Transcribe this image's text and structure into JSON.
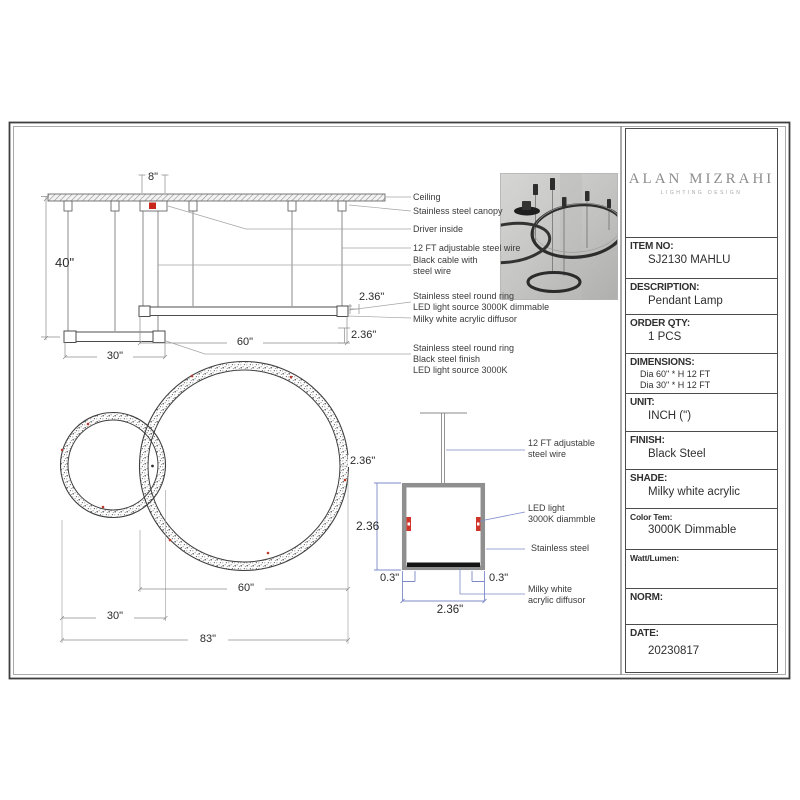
{
  "brand": {
    "name": "ALAN MIZRAHI",
    "tagline": "LIGHTING DESIGN"
  },
  "panel": {
    "item_label": "ITEM NO:",
    "item_value": "SJ2130 MAHLU",
    "desc_label": "DESCRIPTION:",
    "desc_value": "Pendant Lamp",
    "qty_label": "ORDER QTY:",
    "qty_value": "1 PCS",
    "dim_label": "DIMENSIONS:",
    "dim_value1": "Dia 60\" * H 12 FT",
    "dim_value2": "Dia 30\" * H 12 FT",
    "unit_label": "UNIT:",
    "unit_value": "INCH (\")",
    "finish_label": "FINISH:",
    "finish_value": "Black Steel",
    "shade_label": "SHADE:",
    "shade_value": "Milky white acrylic",
    "color_label": "Color Tem:",
    "color_value": "3000K Dimmable",
    "watt_label": "Watt/Lumen:",
    "watt_value": "",
    "norm_label": "NORM:",
    "norm_value": "",
    "date_label": "DATE:",
    "date_value": "20230817"
  },
  "elevation": {
    "dim_8": "8\"",
    "dim_40": "40\"",
    "dim_60": "60\"",
    "dim_30": "30\"",
    "dim_236_top": "2.36\"",
    "dim_236_bottom": "2.36\"",
    "label_ceiling": "Ceiling",
    "label_canopy": "Stainless steel canopy",
    "label_driver": "Driver inside",
    "label_wire": "12 FT adjustable steel wire",
    "label_black_cable_1": "Black cable with",
    "label_black_cable_2": "steel wire",
    "label_ring_top_1": "Stainless steel round ring",
    "label_ring_top_2": "LED light source 3000K dimmable",
    "label_diffusor": "Milky white acrylic diffusor",
    "label_ring_bot_1": "Stainless steel round ring",
    "label_ring_bot_2": "Black steel finish",
    "label_ring_bot_3": "LED light source 3000K"
  },
  "plan": {
    "dim_236": "2.36\"",
    "dim_60": "60\"",
    "dim_30": "30\"",
    "dim_83": "83\""
  },
  "section": {
    "label_wire_1": "12 FT adjustable",
    "label_wire_2": "steel wire",
    "label_led_1": "LED light",
    "label_led_2": "3000K diammble",
    "label_steel": "Stainless steel",
    "label_milky_1": "Milky white",
    "label_milky_2": "acrylic diffusor",
    "dim_left": "2.36",
    "dim_03_left": "0.3\"",
    "dim_03_right": "0.3\"",
    "dim_bottom": "2.36\""
  },
  "colors": {
    "accent_red": "#c8251b",
    "dim_blue": "#7d8ac9"
  }
}
